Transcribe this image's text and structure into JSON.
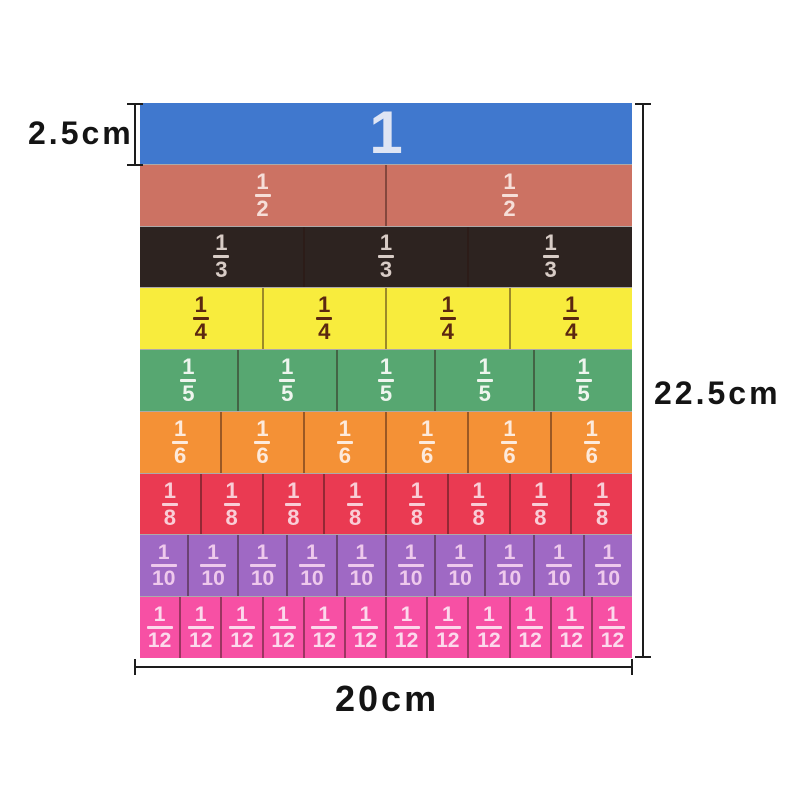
{
  "dimensions": {
    "tile_height": "2.5cm",
    "total_height": "22.5cm",
    "total_width": "20cm"
  },
  "style": {
    "background": "#ffffff",
    "line_color": "#1d1d1d",
    "dimension_text_color": "#141414"
  },
  "tiles": {
    "divider_color": "rgba(45,20,15,0.45)",
    "rows": [
      {
        "label": "1",
        "numerator": "1",
        "denominator": "",
        "segments": 1,
        "color": "#4078ce",
        "text_color": "#dfe5f4"
      },
      {
        "label": "1/2",
        "numerator": "1",
        "denominator": "2",
        "segments": 2,
        "color": "#cc7263",
        "text_color": "#f6ded8"
      },
      {
        "label": "1/3",
        "numerator": "1",
        "denominator": "3",
        "segments": 3,
        "color": "#2d2320",
        "text_color": "#d8ccc6"
      },
      {
        "label": "1/4",
        "numerator": "1",
        "denominator": "4",
        "segments": 4,
        "color": "#f8ec3d",
        "text_color": "#5b2710"
      },
      {
        "label": "1/5",
        "numerator": "1",
        "denominator": "5",
        "segments": 5,
        "color": "#57a771",
        "text_color": "#eef5ee"
      },
      {
        "label": "1/6",
        "numerator": "1",
        "denominator": "6",
        "segments": 6,
        "color": "#f49136",
        "text_color": "#fdeadc"
      },
      {
        "label": "1/8",
        "numerator": "1",
        "denominator": "8",
        "segments": 8,
        "color": "#ea3a52",
        "text_color": "#f9cdd6"
      },
      {
        "label": "1/10",
        "numerator": "1",
        "denominator": "10",
        "segments": 10,
        "color": "#9f69c4",
        "text_color": "#eec9ec"
      },
      {
        "label": "1/12",
        "numerator": "1",
        "denominator": "12",
        "segments": 12,
        "color": "#f750a4",
        "text_color": "#fcd9ec"
      }
    ]
  }
}
